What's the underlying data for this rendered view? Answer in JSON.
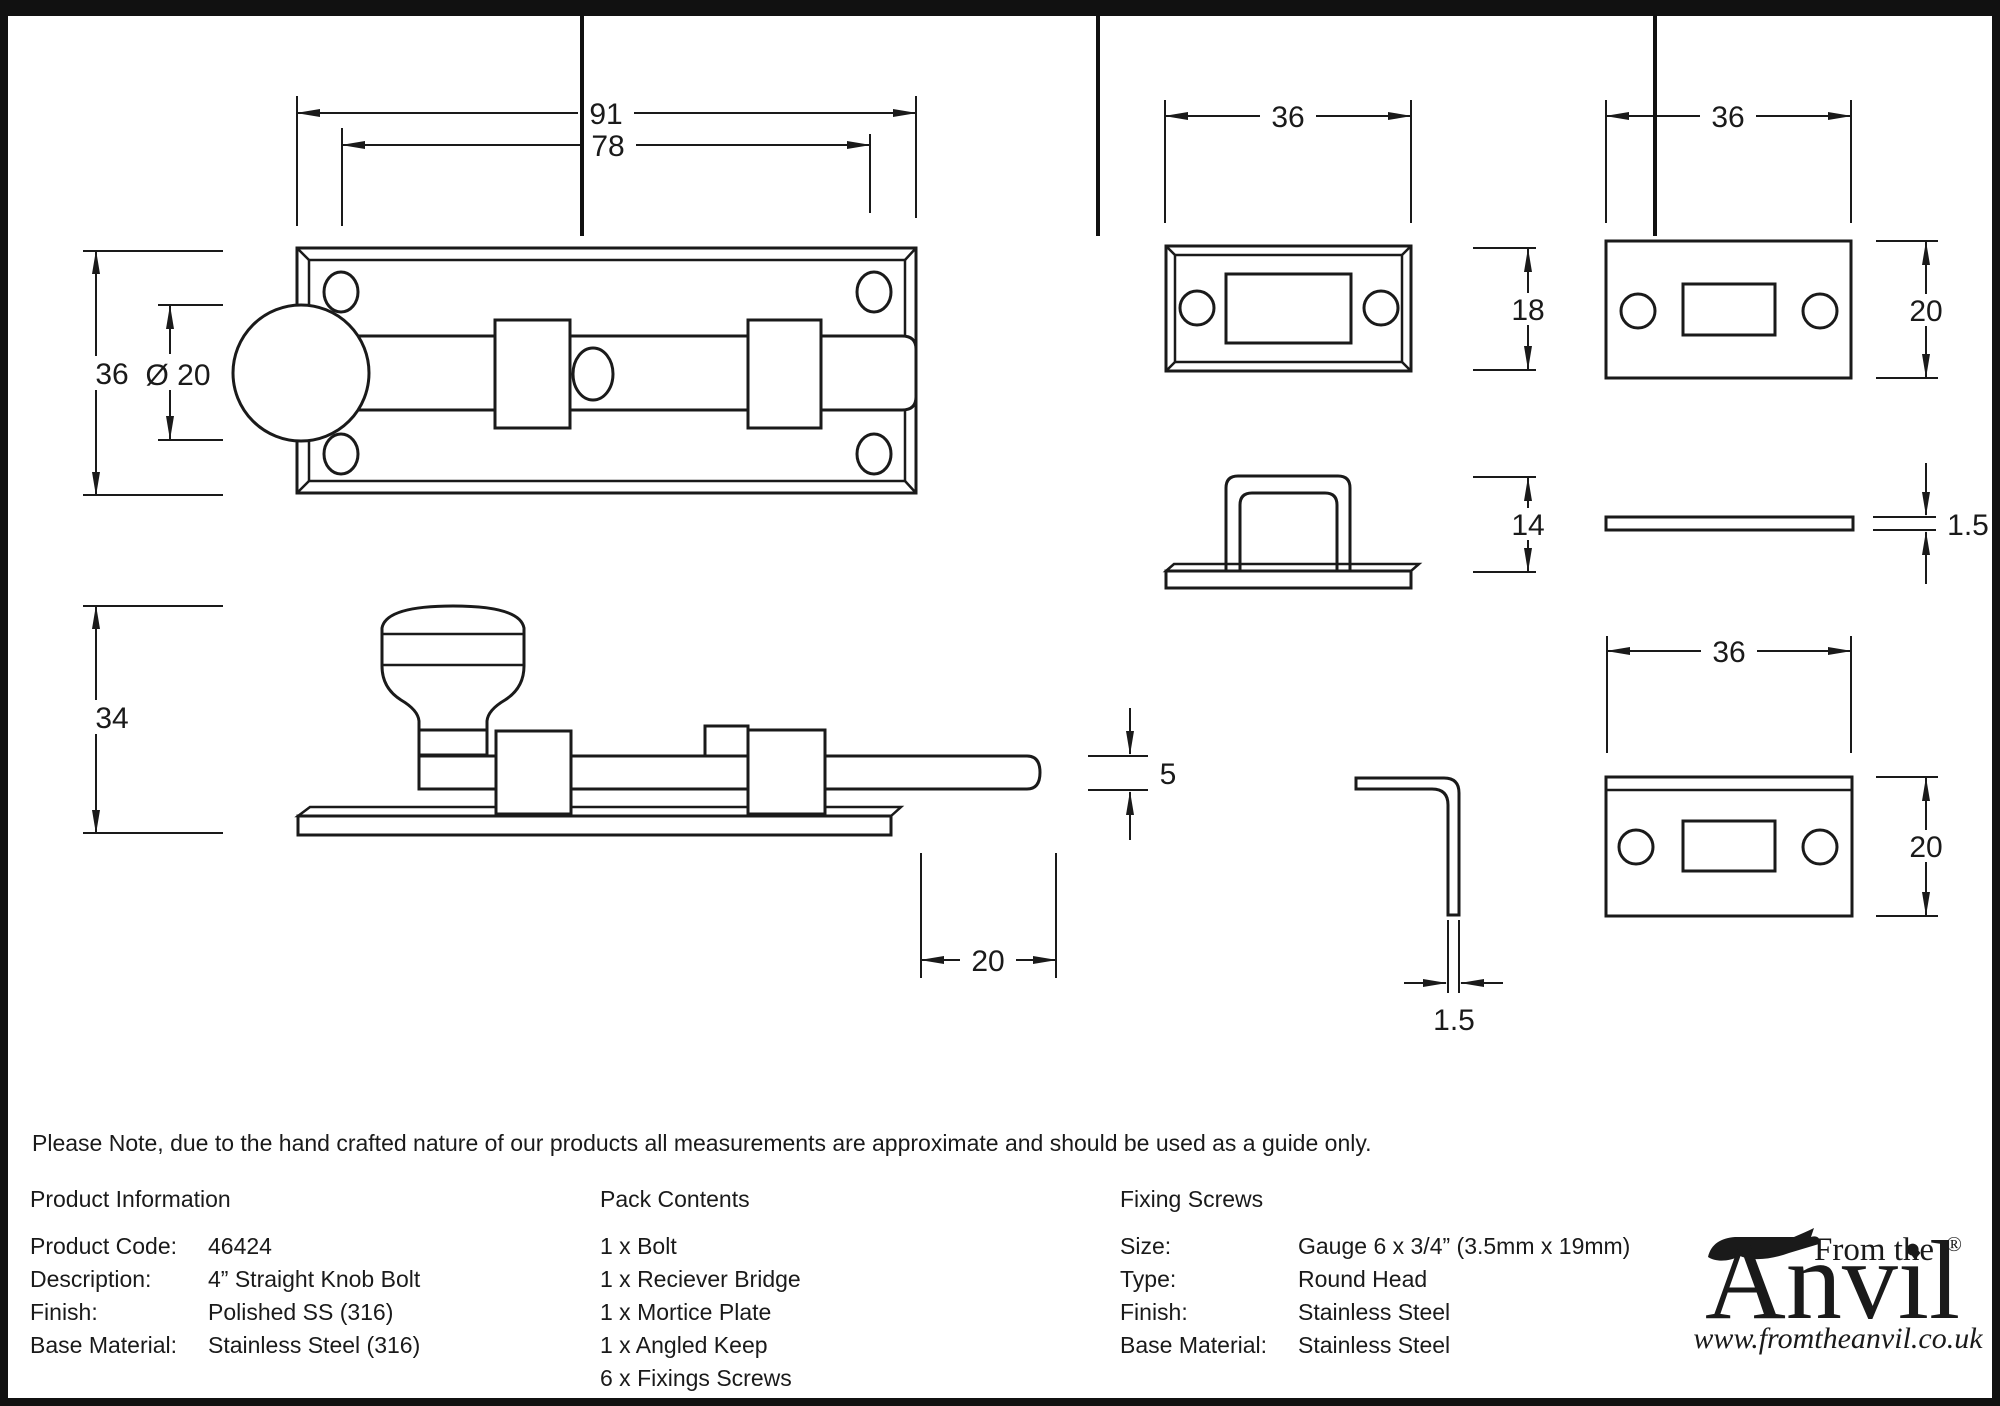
{
  "note": "Please Note, due to the hand crafted nature of our products all measurements are approximate and should be used as a guide only.",
  "dimensions": {
    "bolt_front": {
      "overall_width": "91",
      "inner_width": "78",
      "plate_height": "36",
      "knob_diameter": "Ø 20"
    },
    "bolt_side": {
      "overall_height": "34",
      "rod_diameter": "5",
      "bolt_throw": "20"
    },
    "receiver_bridge_front": {
      "width": "36",
      "height": "18"
    },
    "receiver_bridge_side": {
      "height": "14"
    },
    "mortice_plate_front": {
      "width": "36",
      "height": "20"
    },
    "mortice_plate_side": {
      "thickness": "1.5"
    },
    "angled_keep_side": {
      "thickness": "1.5"
    },
    "angled_keep_front": {
      "width": "36",
      "height": "20"
    }
  },
  "table": {
    "product_information": {
      "title": "Product Information",
      "rows": [
        {
          "label": "Product Code:",
          "value": "46424"
        },
        {
          "label": "Description:",
          "value": "4” Straight Knob Bolt"
        },
        {
          "label": "Finish:",
          "value": "Polished SS (316)"
        },
        {
          "label": "Base Material:",
          "value": "Stainless Steel (316)"
        }
      ]
    },
    "pack_contents": {
      "title": "Pack Contents",
      "items": [
        "1 x Bolt",
        "1 x Reciever Bridge",
        "1 x Mortice Plate",
        "1 x Angled Keep",
        "6 x Fixings Screws"
      ]
    },
    "fixing_screws": {
      "title": "Fixing Screws",
      "rows": [
        {
          "label": "Size:",
          "value": "Gauge 6 x 3/4” (3.5mm x 19mm)"
        },
        {
          "label": "Type:",
          "value": "Round Head"
        },
        {
          "label": "Finish:",
          "value": "Stainless Steel"
        },
        {
          "label": "Base Material:",
          "value": "Stainless Steel"
        }
      ]
    }
  },
  "logo": {
    "tagline": "From the",
    "brand": "Anvil",
    "registered": "®",
    "diamond": "♦",
    "url": "www.fromtheanvil.co.uk"
  }
}
